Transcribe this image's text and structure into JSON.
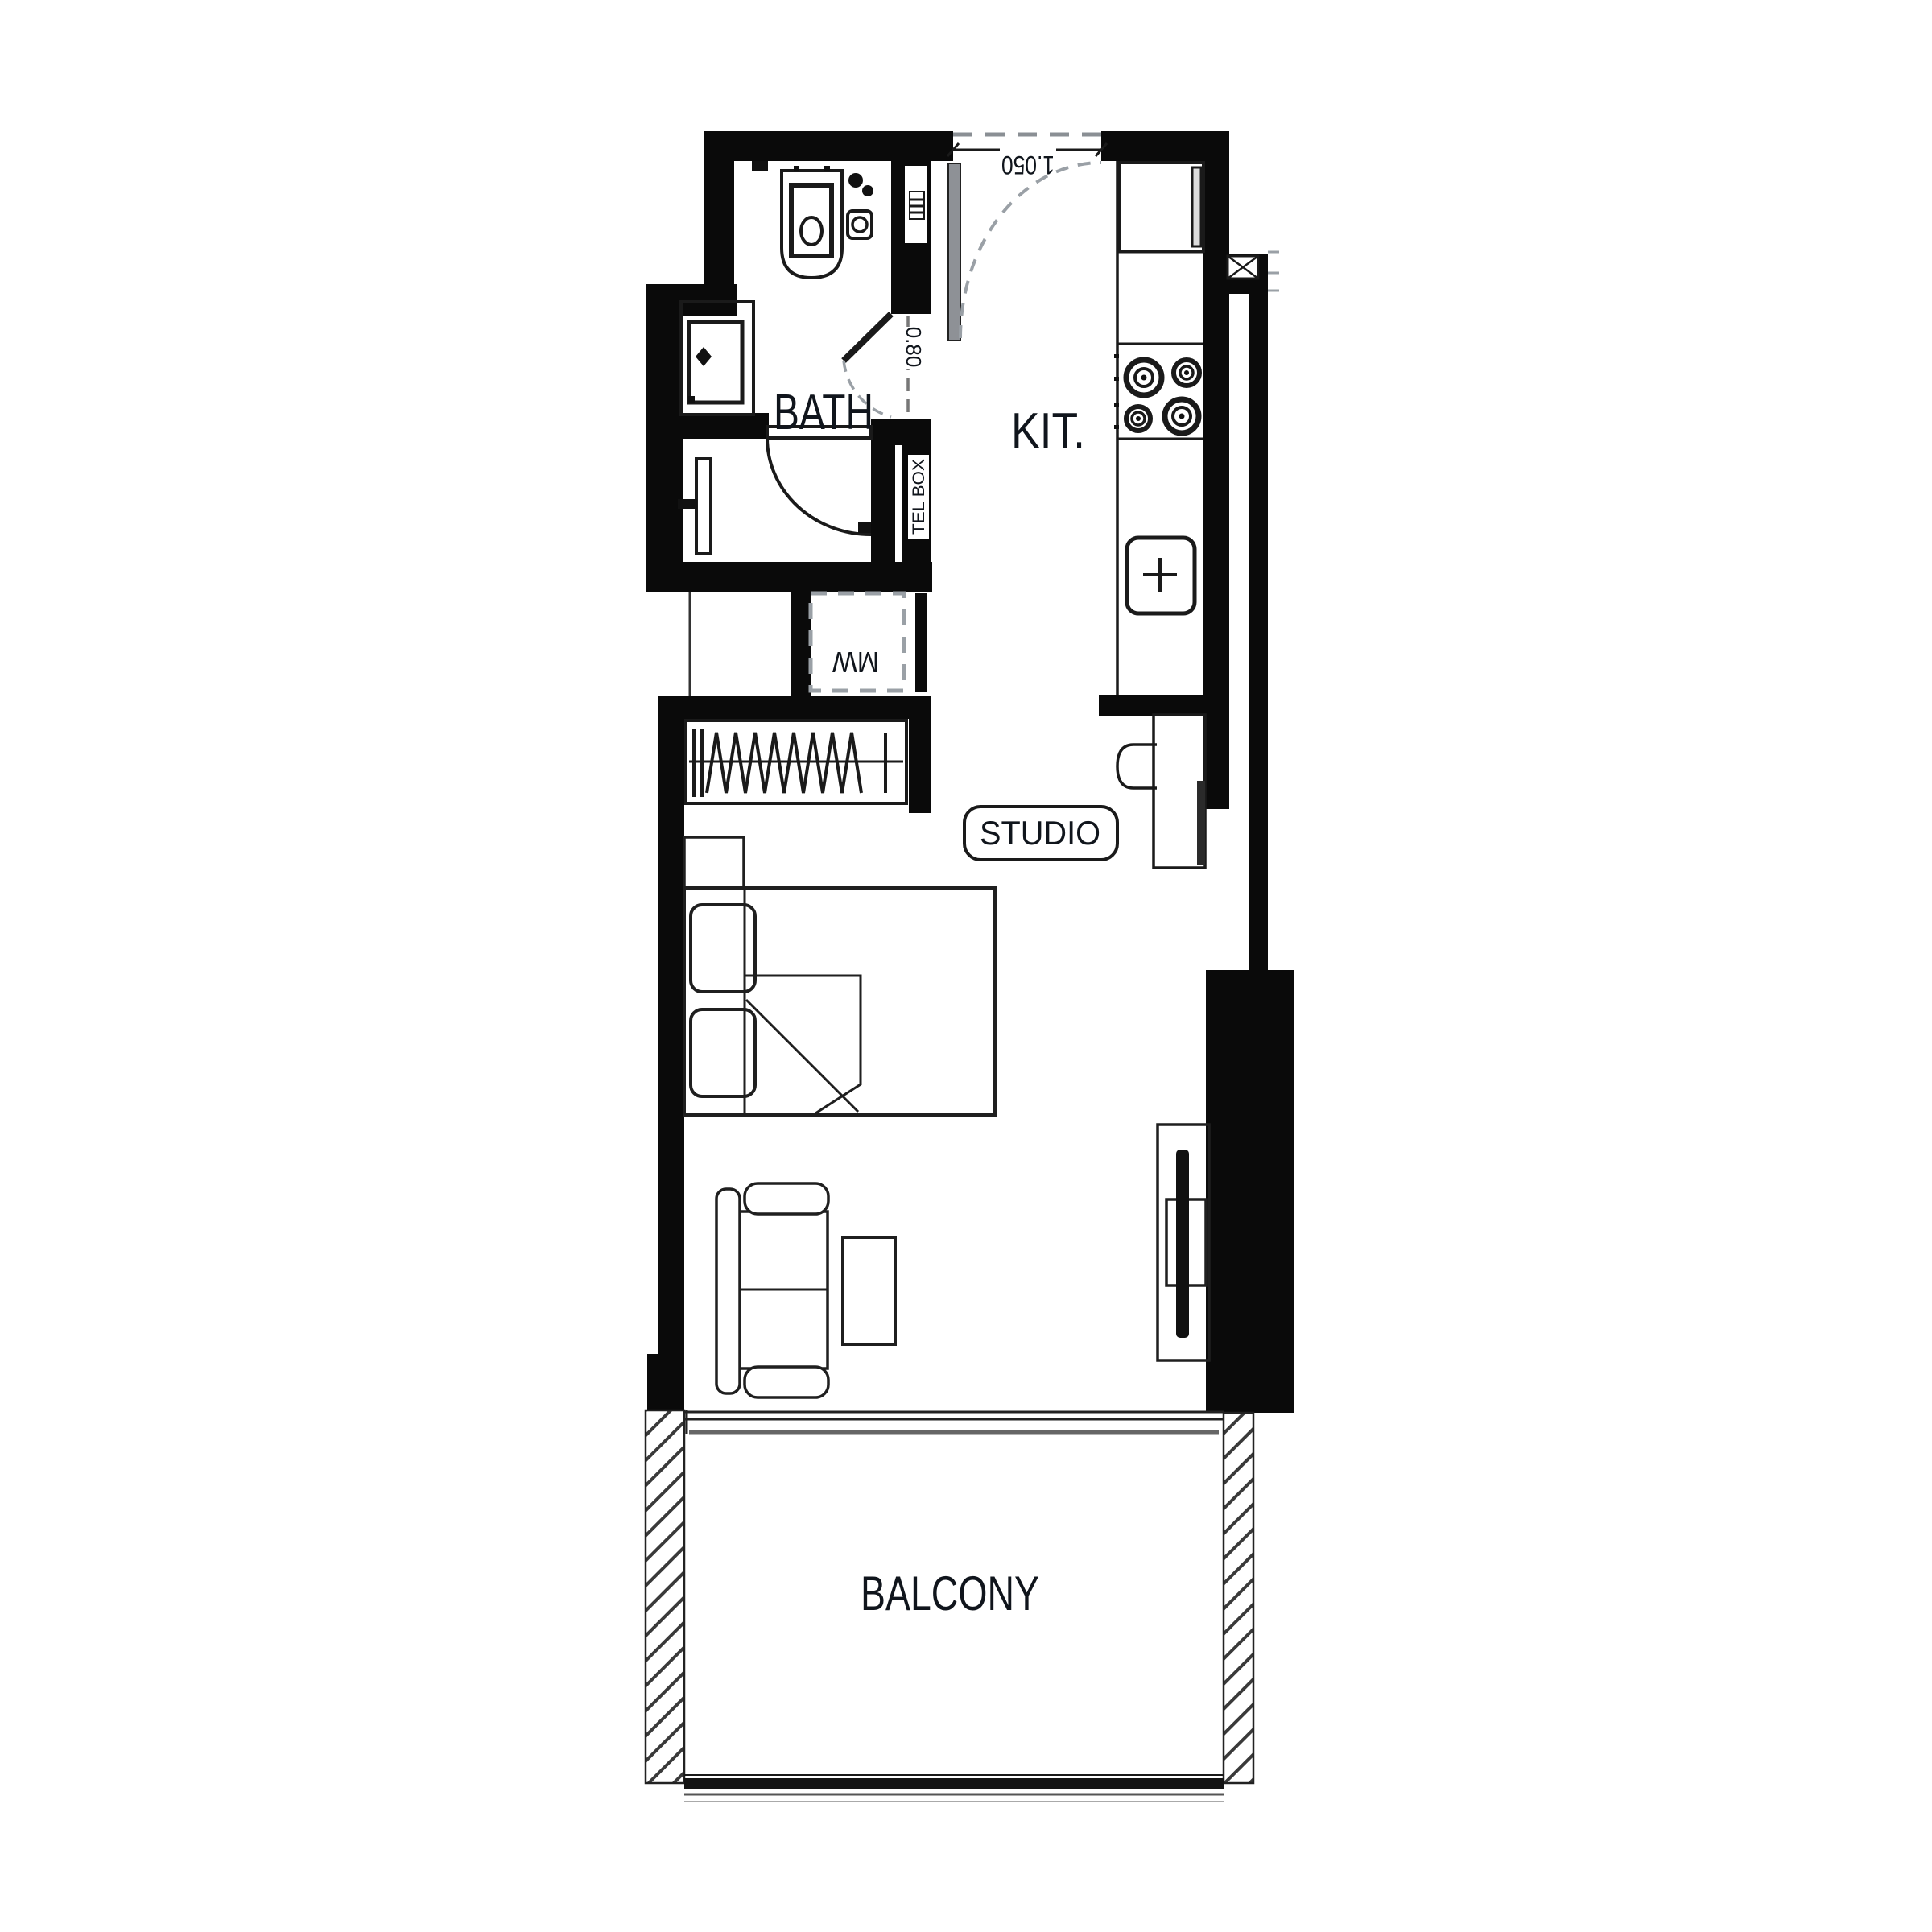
{
  "page": {
    "background": "#ffffff"
  },
  "floor_plan": {
    "name": "studio-apartment-floor-plan",
    "rooms": {
      "bath": {
        "label": "BATH"
      },
      "kitchen": {
        "label": "KIT."
      },
      "studio": {
        "label": "STUDIO"
      },
      "balcony": {
        "label": "BALCONY"
      }
    },
    "annotations": {
      "entry_door_width": "1.050",
      "bath_door_width": "0.80",
      "microwave_label": "MW",
      "tel_box_label": "TEL BOX"
    },
    "fixtures": [
      "toilet",
      "hand-sprayer",
      "floor-drain",
      "washbasin",
      "shower",
      "shower-door",
      "bath-door",
      "entry-door",
      "fridge",
      "stove",
      "kitchen-sink",
      "microwave",
      "wardrobe",
      "desk",
      "desk-chair",
      "bed",
      "pillows",
      "nightstand",
      "sofa",
      "coffee-table",
      "tv-unit",
      "sliding-balcony-door",
      "balcony-railing"
    ],
    "colors": {
      "wall": "#0a0a0a",
      "line": "#1a1a1a",
      "dashed": "#9aa0a6",
      "muted_text": "#8d9099",
      "label_text": "#10151c"
    }
  }
}
